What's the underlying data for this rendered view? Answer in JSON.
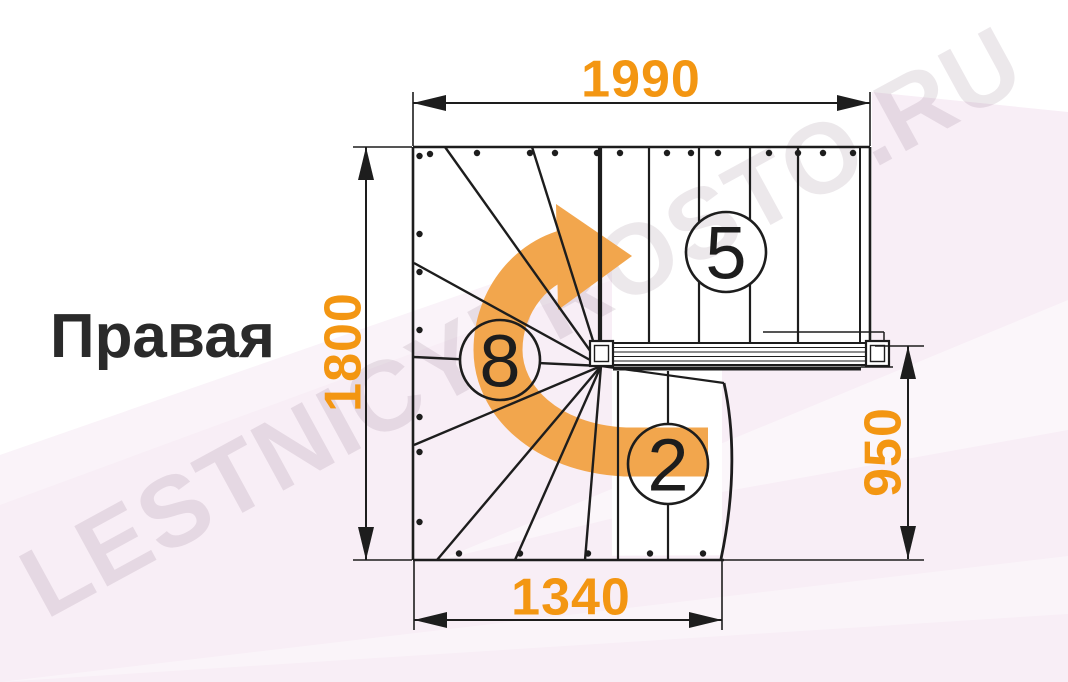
{
  "title": {
    "label": "Правая"
  },
  "watermark": {
    "text": "LESTNICYPROSTO.RU"
  },
  "dimensions": {
    "top_width_mm": "1990",
    "left_height_mm": "1800",
    "right_height_mm": "950",
    "bottom_width_mm": "1340"
  },
  "step_counts": {
    "upper_flight": "5",
    "winder": "8",
    "lower_flight": "2"
  },
  "colors": {
    "dimension_text": "#F39612",
    "arrow_orange": "#F2A64D",
    "line_black": "#1D1D1D",
    "background_pink": "#F8EEF6",
    "watermark_gray": "rgba(70,30,60,0.10)"
  }
}
